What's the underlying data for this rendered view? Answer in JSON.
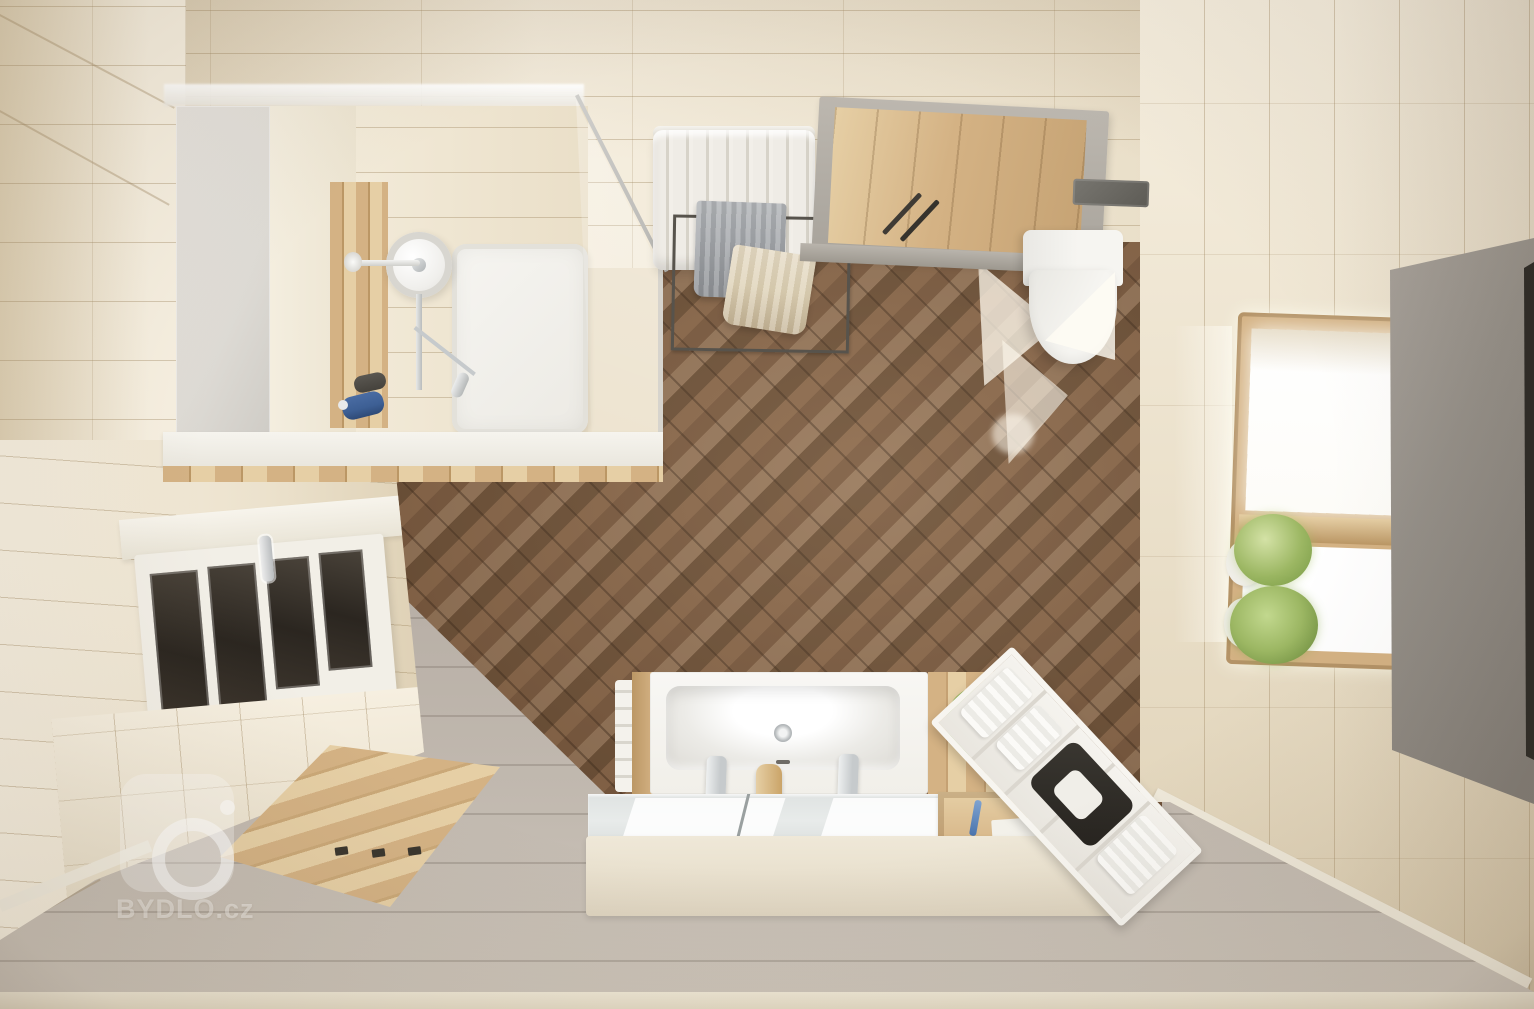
{
  "scene": {
    "type": "3d-interior-render",
    "view": "top-down",
    "room": "bathroom"
  },
  "watermark": {
    "text": "BYDLO.cz",
    "logo": "camera-logo-icon"
  },
  "objects": {
    "shower": "corner shower with rain head, glass screen, wood niche and white tray",
    "radiator": "white column radiator with towel rail, gray and beige towels",
    "entry_door": "open wooden entry door with gray frame and dark handles",
    "toilet": "wall-hung white toilet with dark flush plate",
    "window_right": "bright window with wooden frame and two green plants in white pots",
    "gray_door_panel": "tall gray door panel on the right foreground",
    "window_left": "white-framed window with four dark panes and chrome handle",
    "decking": "light wood deck mat with four dark clips on gray floor",
    "bathtub_vanity": "white bathtub/basin with two chrome faucets, wooden dispenser, wood surround, grass plant, mirror strip and beige front panel",
    "shelf_unit": "white open shelf ladder with towels and black basket",
    "herringbone_floor": "dark walnut herringbone parquet floor",
    "walls": "cream plank-tiled walls",
    "sunlight": "sunlight patches on floor near toilet"
  },
  "palette": {
    "wall-base": "#ece2cd",
    "wall-light": "#f6efe0",
    "wall-dark": "#ddcfb3",
    "wall-seam": "rgba(158,134,96,0.38)",
    "floor-brown-1": "#8a684b",
    "floor-brown-2": "#7a5a40",
    "floor-brown-3": "#95765a",
    "floor-brown-4": "#6d5138",
    "floor-seam": "rgba(52,35,22,0.40)",
    "wood": "#d4b284",
    "wood-dark": "#bb9765",
    "wood-light": "#e6cfa5",
    "gray-floor": "#b6ada4",
    "gray-floor-light": "#c6beb4",
    "gray-floor-seam": "rgba(110,100,90,0.28)",
    "white-fixture": "#f6f5f1",
    "chrome": "#c6cacc",
    "gray-door": "#948f88",
    "gray-door-dark": "#817c76",
    "green": "#9cb763",
    "green-dark": "#7d9e4a",
    "towel-gray": "#a4a7ab",
    "towel-beige": "#dccfb2",
    "blue": "#3d5f94",
    "dark-accessory": "#45423c",
    "mirror": "#e8ebea",
    "panel-beige": "#eae2d0",
    "cabinet-gray": "#dedbd5",
    "radiator": "#efece6",
    "light-sun": "rgba(255,250,238,0.75)",
    "wm-white": "rgba(255,255,255,0.42)"
  }
}
